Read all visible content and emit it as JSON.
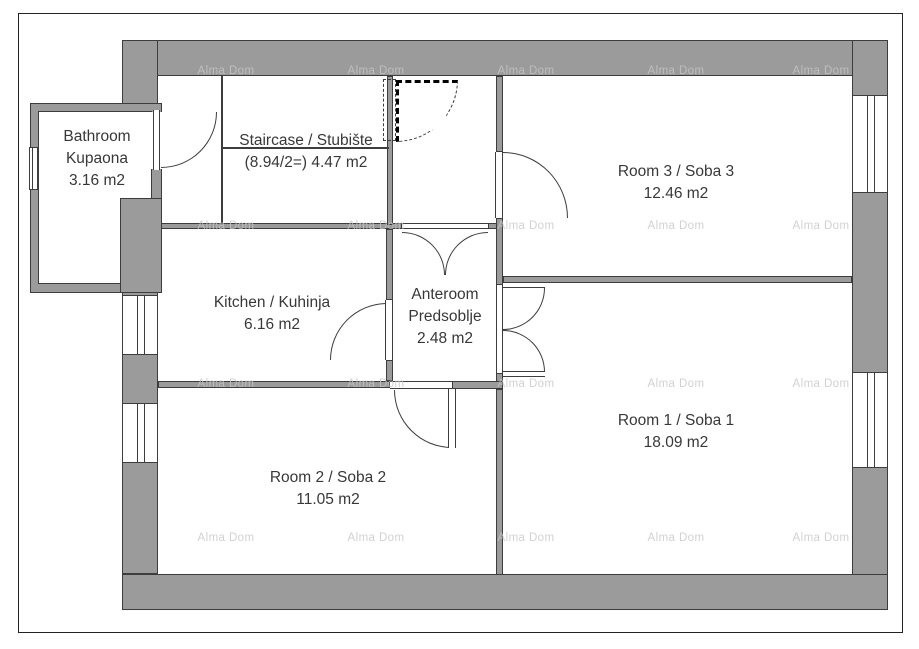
{
  "watermark": {
    "text": "Alma Dom"
  },
  "rooms": {
    "bathroom": {
      "name_en": "Bathroom",
      "name_hr": "Kupaona",
      "area": "3.16 m2"
    },
    "staircase": {
      "label": "Staircase / Stubište",
      "area": "(8.94/2=) 4.47 m2"
    },
    "kitchen": {
      "label": "Kitchen / Kuhinja",
      "area": "6.16 m2"
    },
    "anteroom": {
      "name_en": "Anteroom",
      "name_hr": "Predsoblje",
      "area": "2.48 m2"
    },
    "room1": {
      "label": "Room 1 / Soba 1",
      "area": "18.09 m2"
    },
    "room2": {
      "label": "Room 2 / Soba 2",
      "area": "11.05 m2"
    },
    "room3": {
      "label": "Room 3 / Soba 3",
      "area": "12.46 m2"
    }
  },
  "colors": {
    "wall": "#9b9b9b",
    "line": "#3d3d3d",
    "text": "#383838",
    "watermark": "#c6c6c6"
  }
}
